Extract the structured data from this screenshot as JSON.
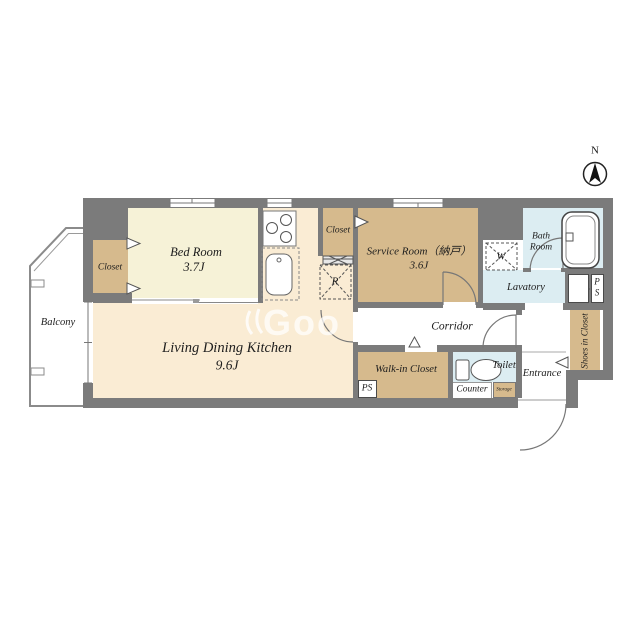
{
  "compass": {
    "north_label": "N"
  },
  "watermark": {
    "text": "Goo"
  },
  "rooms": {
    "balcony": {
      "name": "Balcony"
    },
    "bedroom": {
      "name": "Bed Room",
      "area": "3.7J"
    },
    "bedroom_closet": {
      "name": "Closet"
    },
    "ldk": {
      "name": "Living Dining Kitchen",
      "area": "9.6J"
    },
    "hall_closet": {
      "name": "Closet"
    },
    "service_room": {
      "name": "Service Room（納戸）",
      "area": "3.6J"
    },
    "bath_room": {
      "name_line1": "Bath",
      "name_line2": "Room"
    },
    "lavatory": {
      "name": "Lavatory"
    },
    "corridor": {
      "name": "Corridor"
    },
    "walk_in_closet": {
      "name": "Walk-in Closet"
    },
    "toilet": {
      "name": "Toilet"
    },
    "counter": {
      "name": "Counter"
    },
    "storage": {
      "name": "Storage"
    },
    "entrance": {
      "name": "Entrance"
    },
    "shoes_closet": {
      "name": "Shoes in Closet"
    }
  },
  "equipment": {
    "washer_label": "W",
    "refrigerator_label": "R",
    "pipe_shaft_upper_line1": "P",
    "pipe_shaft_upper_line2": "S",
    "pipe_shaft_lower": "PS"
  },
  "colors": {
    "wall": "#7b7b7b",
    "bedroom_fill": "#f6f2d7",
    "ldk_fill": "#faecd4",
    "closet_fill": "#d6ba8d",
    "wet_area_fill": "#dcedf2",
    "line": "#777777",
    "text": "#1d1d1d"
  }
}
